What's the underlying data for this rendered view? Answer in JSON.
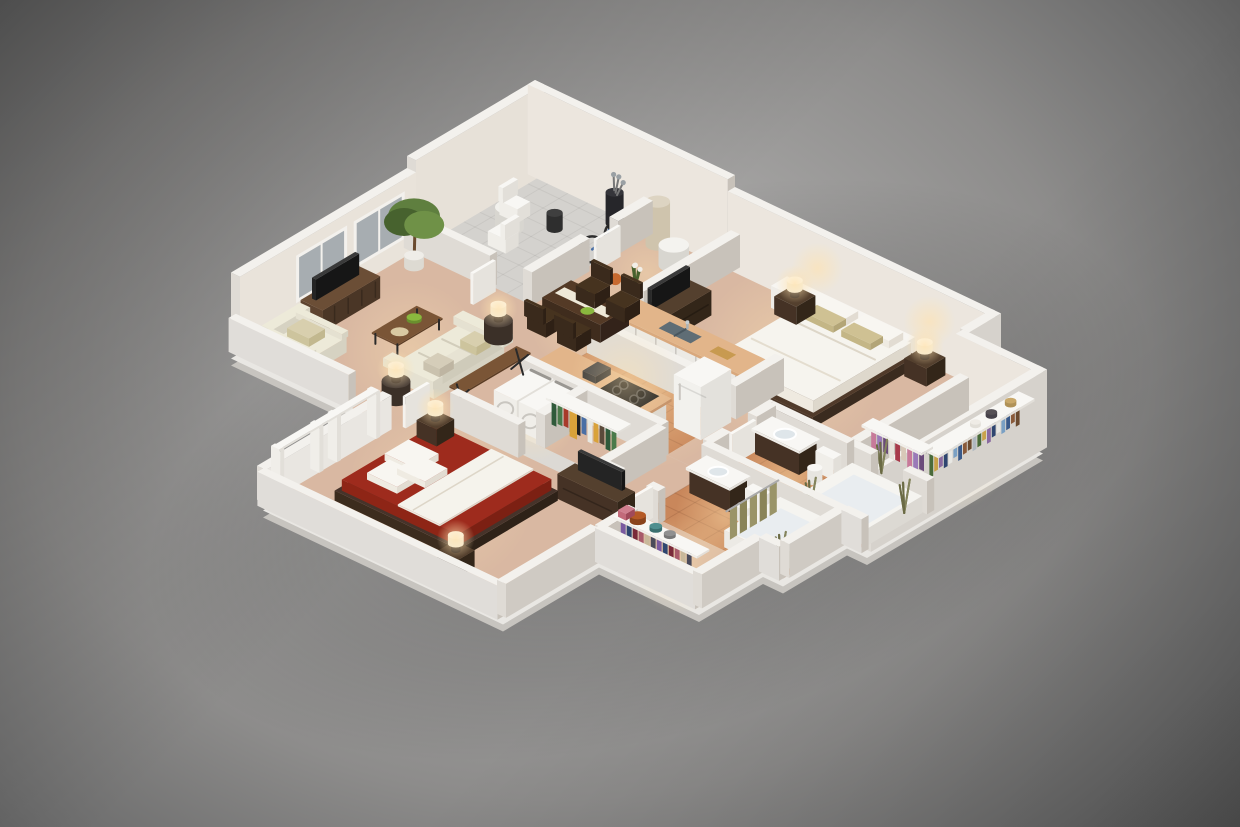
{
  "scene": {
    "alt": "3D isometric cutaway rendering of a two-bedroom two-bathroom apartment floor plan on a gray studio background",
    "view": "isometric-dollhouse",
    "text_visible": "none"
  },
  "background": {
    "center": "#b5b3b1",
    "mid": "#8d8c8b",
    "edge": "#484848"
  },
  "palette": {
    "wall_top": "#f3f1ed",
    "wall_se": "#c8c2ba",
    "wall_sw": "#dfdbd5",
    "wall_inner_warm": "#ece6de",
    "wall_outer_bright": "#d6d2cc",
    "slab_light": "#e9e7e3",
    "slab_dark": "#c7c4bf",
    "carpet": "#d9b8a2",
    "carpet_light": "#eccfb2",
    "tile": "#c9875b",
    "grout": "rgba(120,70,40,0.22)",
    "patio_floor": "#d4d2ce",
    "laundry_floor": "#e7e4df",
    "wood_dark": "#46332a",
    "wood_mid": "#5e4430",
    "wood_warm": "#7a5536",
    "white_furniture": "#f5f4f0",
    "cream_fabric": "#eae6d6",
    "pillow_accent": "#cfc193",
    "bed_white": "#f6f4ee",
    "bed2_red": "#9e2b1d",
    "bed2_red_dark": "#7c2013",
    "tv_screen": "#242424",
    "sink_steel": "#5f6d75",
    "window_glass": "#a7adb1",
    "plant_green": "#5f7f3f",
    "plant_dark": "#47622e",
    "grass_olive": "#84845c",
    "glow": "#ffe3b0",
    "bike_blue": "#4a6fa5",
    "basketball": "#c7692f",
    "cutting_board": "#c89a50",
    "runner": "#efe9d8",
    "bowl_green": "#8ab83e",
    "hatbox_orange": "#b55a26",
    "hat_teal": "#4f8f8f",
    "curtain_olive": "#9a9468"
  },
  "clothes": {
    "master_closet_back": [
      "#6b4a2f",
      "#8a5a3a",
      "#3a5a8a",
      "#7aa0c4",
      "#e8e8e4",
      "#2f4670",
      "#8a6aa0",
      "#c9a24a",
      "#4a6b3a",
      "#b0b8c0"
    ],
    "master_closet_side": [
      "#c77a9a",
      "#9a7ab8",
      "#6a4a7a",
      "#e8e2da",
      "#a83a4a",
      "#d8c8b8"
    ],
    "bedroom2_closet": [
      "#2f5a3a",
      "#4a7a4a",
      "#a83a2a",
      "#23304a",
      "#202020",
      "#4a6fa5",
      "#e8e8e2",
      "#d9a23a",
      "#5a4a3a"
    ],
    "closet2": [
      "#7a5aa0",
      "#2f4670",
      "#7a2a3a",
      "#a85a6a",
      "#c8b89a",
      "#4a4a5a"
    ]
  },
  "inventory": {
    "patio_storage": [
      "bistro-table",
      "bistro-chairs",
      "bar-stool",
      "golf-bag",
      "bicycle",
      "basketball"
    ],
    "entry": [
      "water-heater",
      "round-side-table",
      "flower-planter"
    ],
    "living_room": [
      "window-wall",
      "tv-console",
      "flat-screen-tv",
      "potted-ficus-tree",
      "armchair",
      "sofa",
      "coffee-table",
      "fruit-bowl",
      "console-table",
      "pedestal-lamps"
    ],
    "dining_area": [
      "dining-table",
      "table-runner",
      "place-settings",
      "dining-chairs"
    ],
    "kitchen": [
      "island-counter",
      "double-sink",
      "faucet",
      "cutting-board",
      "base-cabinets",
      "cooktop",
      "refrigerator"
    ],
    "laundry_closet": [
      "washer",
      "dryer"
    ],
    "master_bedroom": [
      "queen-bed",
      "white-duvet",
      "accent-pillows",
      "nightstands",
      "table-lamps",
      "wall-sconces",
      "built-in-cabinets",
      "dresser",
      "flat-screen-tv"
    ],
    "master_walk_in_closet": [
      "hanging-clothes",
      "shelves",
      "hats"
    ],
    "master_bathroom": [
      "vanity-sink",
      "toilet",
      "bathtub",
      "grass-plants"
    ],
    "second_bathroom": [
      "vanity-sink",
      "toilet",
      "bathtub",
      "shower-curtain",
      "grass-plant"
    ],
    "second_bedroom": [
      "red-bed",
      "white-blanket",
      "pillows",
      "nightstands",
      "table-lamps",
      "dresser",
      "flat-screen-tv",
      "window-frames"
    ],
    "second_bedroom_closet": [
      "hanging-clothes",
      "shelf",
      "gold-jacket"
    ],
    "hall_closet": [
      "shelf",
      "hat-box",
      "hats",
      "purse",
      "hanging-clothes"
    ]
  }
}
